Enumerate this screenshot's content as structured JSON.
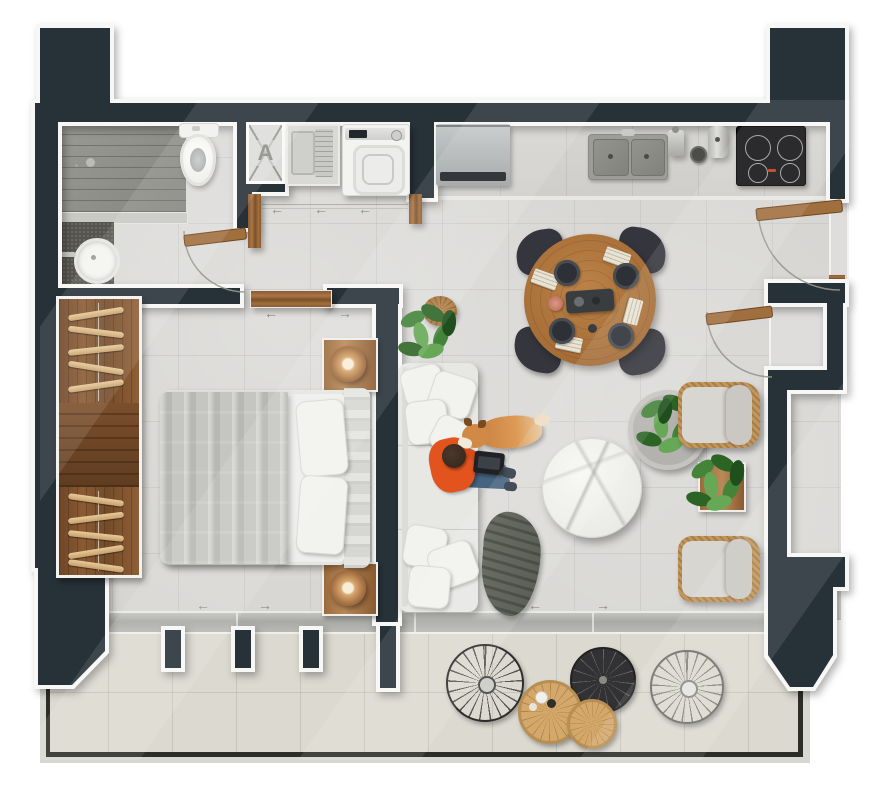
{
  "meta": {
    "title": "Apartment floor plan — top-down render",
    "type": "floor-plan"
  },
  "labels": {
    "shaft": "A"
  },
  "glyphs": {
    "arrowLeft": "←",
    "arrowRight": "→"
  },
  "colors": {
    "wall": "#263138",
    "trim": "#f7f7f5",
    "floor": "#d6d5d2",
    "balconyFloor": "#dcd9d0",
    "glass": "#b3b3af",
    "railing": "#2e2e28",
    "wood": "#8a5a33",
    "doorWood": "#a06f3e",
    "tableWood": "#ad7742",
    "wicker": "#c49659",
    "sofa": "#e7e7e4",
    "duvet": "#c5c5c1",
    "marble": "#f2f2ef",
    "cooktop": "#131315",
    "steel": "#b4b8b9",
    "plantDark": "#2c6426",
    "plantMid": "#44833a",
    "plantLight": "#67a857",
    "shirtOrange": "#e2531d",
    "denim": "#4f6e8d",
    "dogCoat": "#cc8440",
    "lampCopper": "#a57043"
  },
  "rooms": [
    {
      "name": "Bathroom",
      "items": [
        "walk-in shower",
        "toilet",
        "round basin vanity",
        "hinged door"
      ]
    },
    {
      "name": "Laundry nook",
      "items": [
        "utility sink",
        "washing machine",
        "sliding doors"
      ]
    },
    {
      "name": "Kitchen",
      "items": [
        "refrigerator",
        "counter run",
        "double sink",
        "moka pot",
        "utensil crock",
        "induction cooktop"
      ]
    },
    {
      "name": "Dining area",
      "items": [
        "round wood table",
        "4 upholstered chairs",
        "4 place settings",
        "serving board",
        "copper coaster"
      ]
    },
    {
      "name": "Living area",
      "items": [
        "sectional sofa",
        "scatter pillows",
        "throw blanket",
        "round marble coffee table",
        "potted plant",
        "floor pouf",
        "person with laptop",
        "corgi dog",
        "2 wicker armchairs",
        "plant stand"
      ]
    },
    {
      "name": "Bedroom",
      "items": [
        "double bed",
        "channel headboard",
        "2 pillows",
        "2 wood nightstands",
        "2 rattan globe lamps",
        "wardrobe with hangers",
        "sliding door"
      ]
    },
    {
      "name": "Balcony",
      "items": [
        "glass sliding wall",
        "glass railing",
        "2 wire chairs",
        "dark bistro table",
        "2 round wood tables",
        "coffee cups",
        "mullion posts",
        "structural column"
      ]
    }
  ],
  "doors": [
    "main entry (hinged, right wall)",
    "storage niche (hinged)",
    "bathroom (hinged)",
    "laundry (sliding)",
    "bedroom (sliding)",
    "balcony (sliding glass)"
  ]
}
